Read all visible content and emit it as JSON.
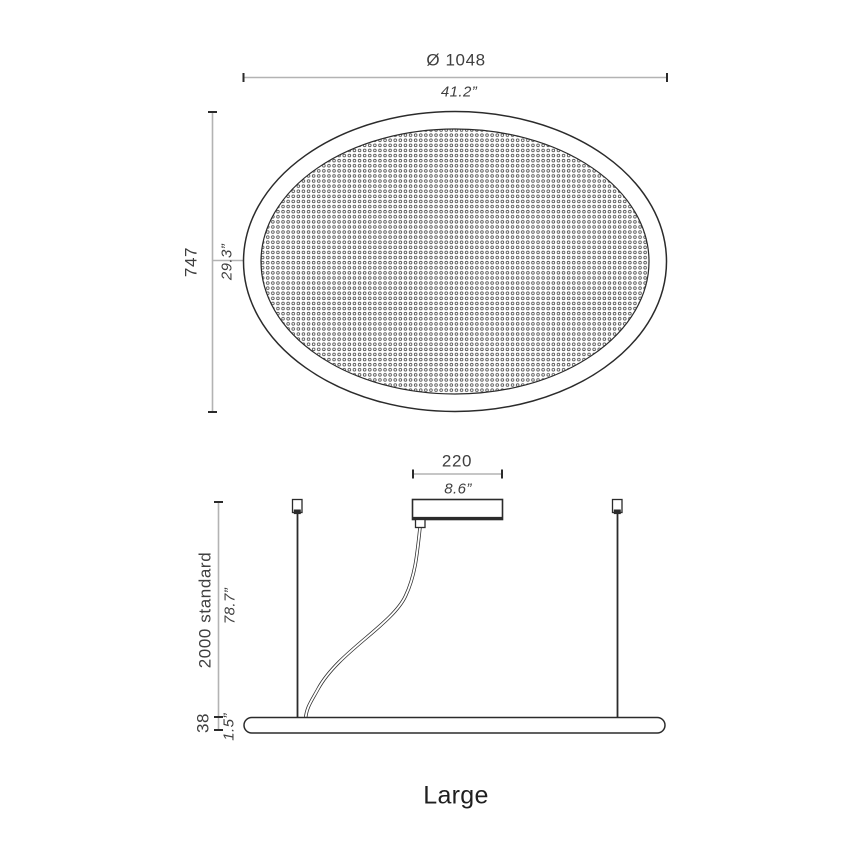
{
  "colors": {
    "ink": "#2b2b2b",
    "dim-line": "#b3b3b3",
    "dot": "#4a4a4a",
    "text": "#3f3f3f",
    "title-text": "#1f1f1f",
    "bg": "#ffffff"
  },
  "drawing_title": "Large",
  "top_view": {
    "diameter": {
      "metric": "Ø 1048",
      "imperial": "41.2”"
    },
    "minor_axis": {
      "metric": "747",
      "imperial": "29.3”"
    }
  },
  "side_view": {
    "canopy_width": {
      "metric": "220",
      "imperial": "8.6”"
    },
    "suspension_height": {
      "metric": "2000 standard",
      "imperial": "78.7”"
    },
    "fixture_thickness": {
      "metric": "38",
      "imperial": "1.5”"
    }
  }
}
